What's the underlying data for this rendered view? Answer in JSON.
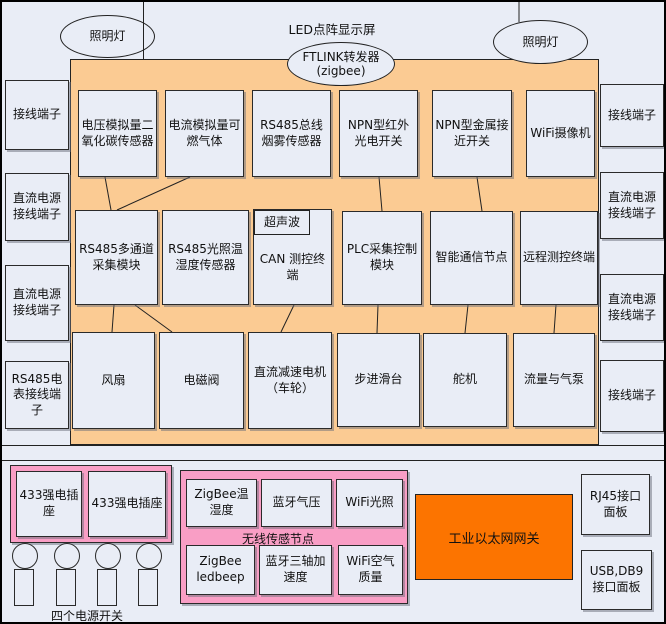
{
  "title": "物联网实训台布局图",
  "top": {
    "led_display_label": "LED点阵显示屏",
    "lamp_left_label": "照明灯",
    "lamp_right_label": "照明灯",
    "ftlink_label": "FTLINK转发器",
    "ftlink_sub_label": "(zigbee)"
  },
  "left_column": {
    "items": [
      "接线端子",
      "直流电源接线端子",
      "直流电源接线端子",
      "RS485电表接线端子"
    ]
  },
  "right_column": {
    "items": [
      "接线端子",
      "直流电源接线端子",
      "直流电源接线端子",
      "接线端子"
    ]
  },
  "sensor_row": {
    "items": [
      "电压模拟量二氧化碳传感器",
      "电流模拟量可燃气体",
      "RS485总线烟雾传感器",
      "NPN型红外光电开关",
      "NPN型金属接近开关",
      "WiFi摄像机"
    ]
  },
  "control_row": {
    "items": [
      "RS485多通道采集模块",
      "RS485光照温湿度传感器",
      "CAN 测控终端",
      "PLC采集控制模块",
      "智能通信节点",
      "远程测控终端"
    ],
    "ultrasonic_tag": "超声波"
  },
  "actuator_row": {
    "items": [
      "风扇",
      "电磁阀",
      "直流减速电机（车轮）",
      "步进滑台",
      "舵机",
      "流量与气泵"
    ]
  },
  "bottom": {
    "socket_1": "433强电插座",
    "socket_2": "433强电插座",
    "power_switch_label": "四个电源开关",
    "wireless_node": {
      "label": "无线传感节点",
      "items": [
        "ZigBee温湿度",
        "蓝牙气压",
        "WiFi光照",
        "ZigBee ledbeep",
        "蓝牙三轴加速度",
        "WiFi空气质量"
      ]
    },
    "gateway_label": "工业以太网网关",
    "panel_rj45": "RJ45接口面板",
    "panel_usb": "USB,DB9接口面板"
  },
  "colors": {
    "background": "#E9EDF6",
    "box_fill": "#E9EDF6",
    "orange_area": "#FBCB93",
    "pink_fill": "#F99EC5",
    "gateway_orange": "#FC7400",
    "line": "#222222"
  }
}
